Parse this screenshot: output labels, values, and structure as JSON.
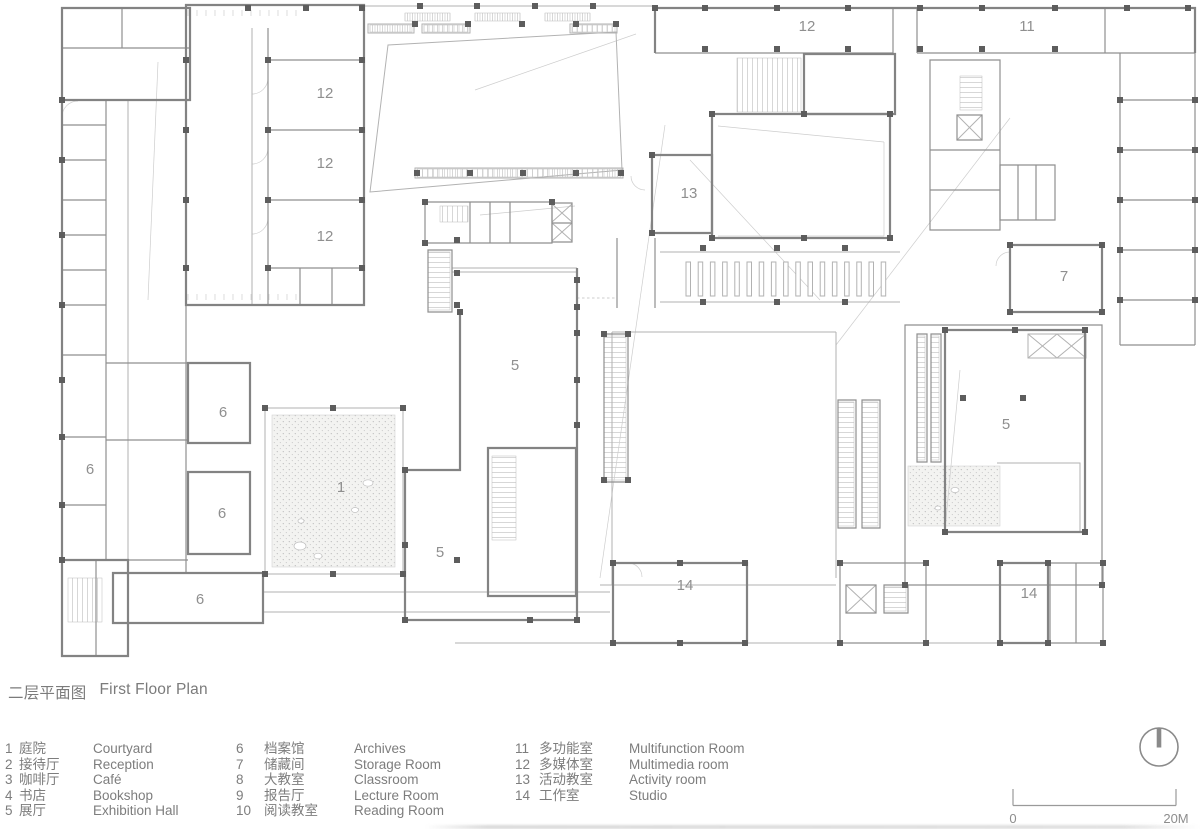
{
  "title": {
    "cn": "二层平面图",
    "en": "First Floor Plan"
  },
  "legend": {
    "columns": [
      {
        "items": [
          {
            "num": "1",
            "cn": "庭院",
            "en": "Courtyard"
          },
          {
            "num": "2",
            "cn": "接待厅",
            "en": "Reception"
          },
          {
            "num": "3",
            "cn": "咖啡厅",
            "en": "Café"
          },
          {
            "num": "4",
            "cn": "书店",
            "en": "Bookshop"
          },
          {
            "num": "5",
            "cn": "展厅",
            "en": "Exhibition Hall"
          }
        ]
      },
      {
        "items": [
          {
            "num": "6",
            "cn": "档案馆",
            "en": "Archives"
          },
          {
            "num": "7",
            "cn": "储藏间",
            "en": "Storage Room"
          },
          {
            "num": "8",
            "cn": "大教室",
            "en": "Classroom"
          },
          {
            "num": "9",
            "cn": "报告厅",
            "en": "Lecture Room"
          },
          {
            "num": "10",
            "cn": "阅读教室",
            "en": "Reading Room"
          }
        ]
      },
      {
        "items": [
          {
            "num": "11",
            "cn": "多功能室",
            "en": "Multifunction Room"
          },
          {
            "num": "12",
            "cn": "多媒体室",
            "en": "Multimedia room"
          },
          {
            "num": "13",
            "cn": "活动教室",
            "en": "Activity room"
          },
          {
            "num": "14",
            "cn": "工作室",
            "en": "Studio"
          }
        ]
      }
    ]
  },
  "scale_bar": {
    "start_label": "0",
    "end_label": "20M"
  },
  "north_arrow": {
    "description": "north-indicator-circle"
  },
  "plan": {
    "room_labels": [
      {
        "text": "12",
        "x": 325,
        "y": 98
      },
      {
        "text": "12",
        "x": 325,
        "y": 168
      },
      {
        "text": "12",
        "x": 325,
        "y": 241
      },
      {
        "text": "12",
        "x": 807,
        "y": 31
      },
      {
        "text": "11",
        "x": 1027,
        "y": 31
      },
      {
        "text": "13",
        "x": 689,
        "y": 198
      },
      {
        "text": "7",
        "x": 1064,
        "y": 281
      },
      {
        "text": "6",
        "x": 223,
        "y": 417
      },
      {
        "text": "6",
        "x": 90,
        "y": 474
      },
      {
        "text": "6",
        "x": 222,
        "y": 518
      },
      {
        "text": "6",
        "x": 200,
        "y": 604
      },
      {
        "text": "1",
        "x": 341,
        "y": 492
      },
      {
        "text": "5",
        "x": 515,
        "y": 370
      },
      {
        "text": "5",
        "x": 440,
        "y": 557
      },
      {
        "text": "5",
        "x": 1006,
        "y": 429
      },
      {
        "text": "14",
        "x": 685,
        "y": 590
      },
      {
        "text": "14",
        "x": 1029,
        "y": 598
      }
    ]
  }
}
